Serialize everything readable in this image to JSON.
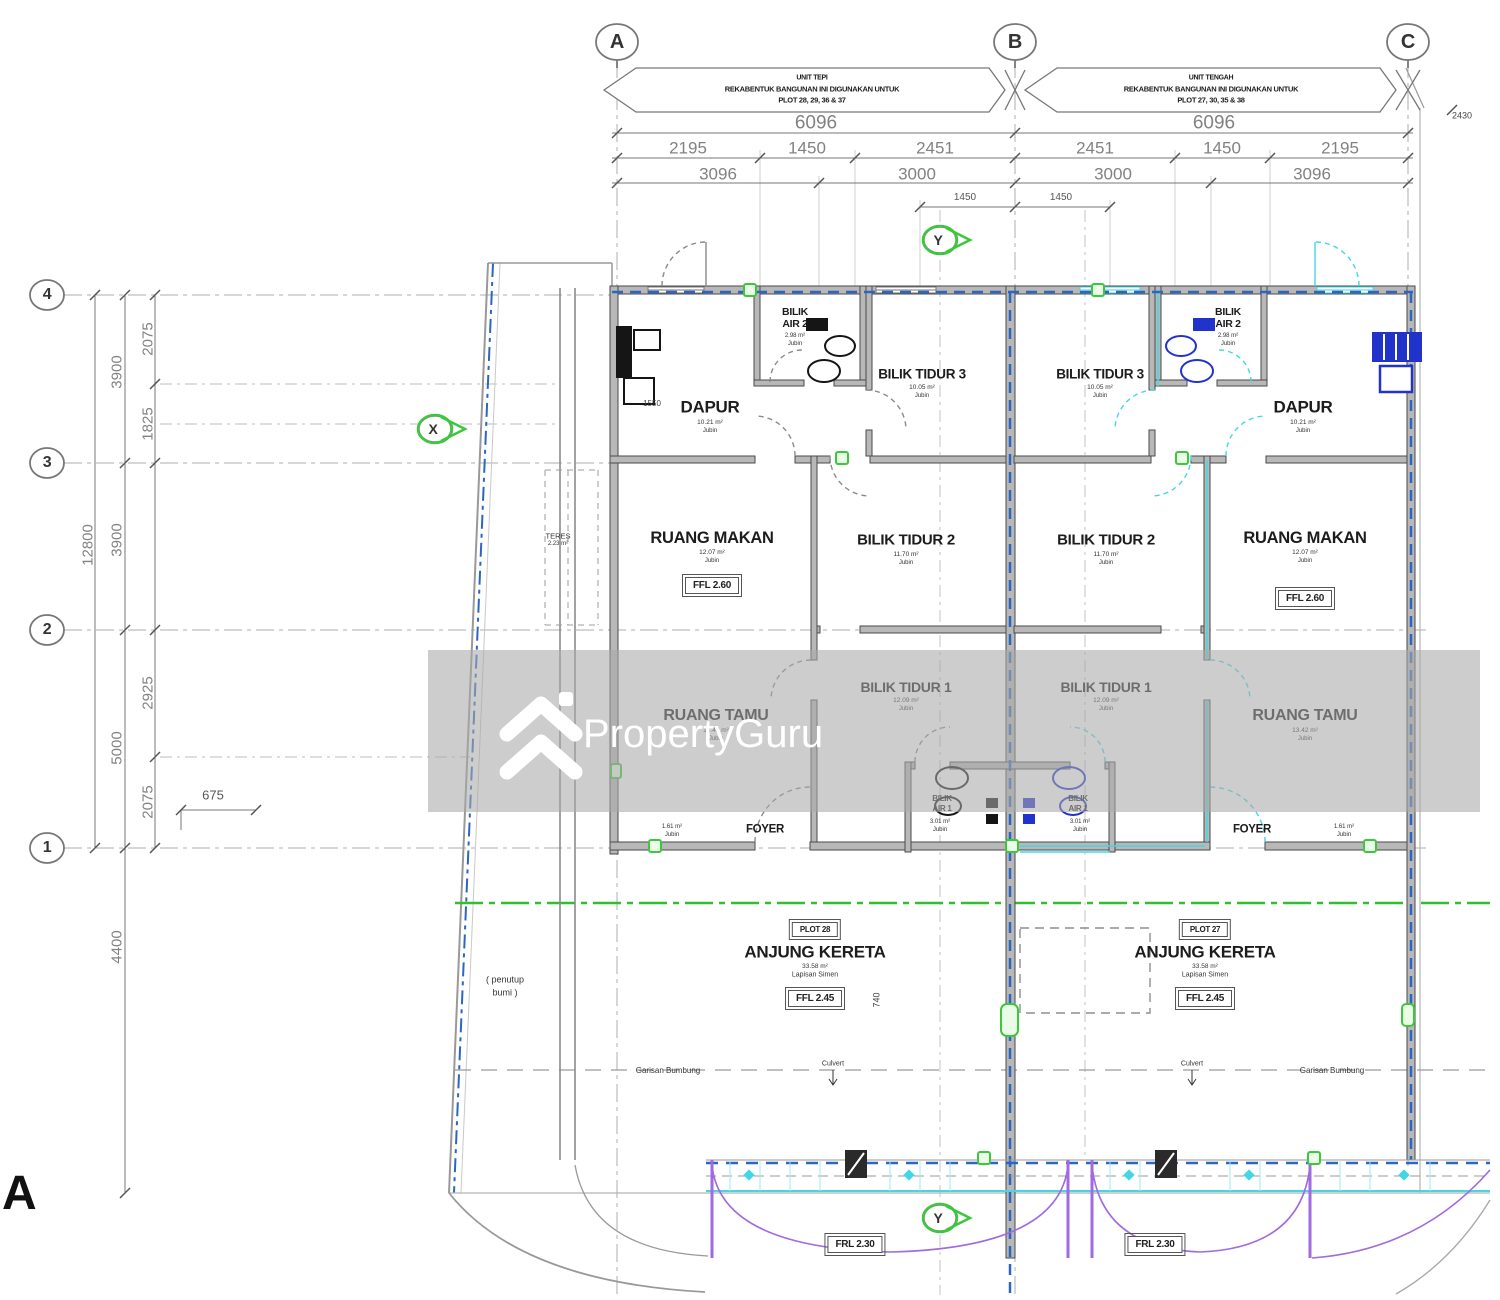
{
  "watermark": {
    "brand": "PropertyGuru"
  },
  "sheet": {
    "label": "A"
  },
  "grid": {
    "cols": [
      "A",
      "B",
      "C"
    ],
    "rows": [
      "4",
      "3",
      "2",
      "1"
    ]
  },
  "banners": {
    "left": {
      "line1": "UNIT TEPI",
      "line2": "REKABENTUK BANGUNAN INI DIGUNAKAN UNTUK",
      "line3": "PLOT 28, 29, 36 & 37"
    },
    "right": {
      "line1": "UNIT TENGAH",
      "line2": "REKABENTUK BANGUNAN INI DIGUNAKAN UNTUK",
      "line3": "PLOT 27, 30, 35 & 38"
    }
  },
  "dims": {
    "top_total": [
      "6096",
      "6096"
    ],
    "top_sub": [
      "2195",
      "1450",
      "2451",
      "2451",
      "1450",
      "2195"
    ],
    "top_sub2": [
      "3096",
      "3000",
      "3000",
      "3096"
    ],
    "top_sub3": [
      "1450",
      "1450"
    ],
    "edge_right": "2430",
    "left_total": "12800",
    "left_major": [
      "3900",
      "3900",
      "5000",
      "4400"
    ],
    "left_minor": [
      "2075",
      "1825",
      "2925",
      "2075"
    ],
    "d675": "675",
    "d740": "740",
    "d1550": "1550"
  },
  "markers": {
    "x": "X",
    "y": "Y"
  },
  "rooms": {
    "bilik_air_2": {
      "name1": "BILIK",
      "name2": "AIR 2",
      "area": "2.98 m²",
      "finish": "Jubin"
    },
    "bilik_tidur_3": {
      "name": "BILIK TIDUR 3",
      "area": "10.05 m²",
      "finish": "Jubin"
    },
    "dapur": {
      "name": "DAPUR",
      "area": "10.21 m²",
      "finish": "Jubin"
    },
    "ruang_makan": {
      "name": "RUANG MAKAN",
      "area": "12.07 m²",
      "finish": "Jubin",
      "level": "FFL 2.60"
    },
    "bilik_tidur_2": {
      "name": "BILIK TIDUR 2",
      "area": "11.70 m²",
      "finish": "Jubin"
    },
    "bilik_tidur_1": {
      "name": "BILIK TIDUR 1",
      "area": "12.09 m²",
      "finish": "Jubin"
    },
    "ruang_tamu": {
      "name": "RUANG TAMU",
      "area": "13.42 m²",
      "finish": "Jubin"
    },
    "bilik_air_1": {
      "name1": "BILIK",
      "name2": "AIR 1",
      "area": "3.01 m²",
      "finish": "Jubin"
    },
    "foyer": {
      "name": "FOYER",
      "area": "1.61 m²",
      "finish": "Jubin"
    },
    "anjung_left": {
      "plot": "PLOT 28",
      "name": "ANJUNG KERETA",
      "area": "33.58 m²",
      "finish": "Lapisan Simen",
      "level": "FFL 2.45"
    },
    "anjung_right": {
      "plot": "PLOT 27",
      "name": "ANJUNG KERETA",
      "area": "33.58 m²",
      "finish": "Lapisan Simen",
      "level": "FFL 2.45"
    },
    "frl": {
      "level": "FRL 2.30"
    }
  },
  "notes": {
    "teres": "TERES",
    "teres_area": "2.23 m²",
    "penutup1": "( penutup",
    "penutup2": "bumi )",
    "garisan_bumbung": "Garisan Bumbung",
    "culvert": "Culvert"
  }
}
